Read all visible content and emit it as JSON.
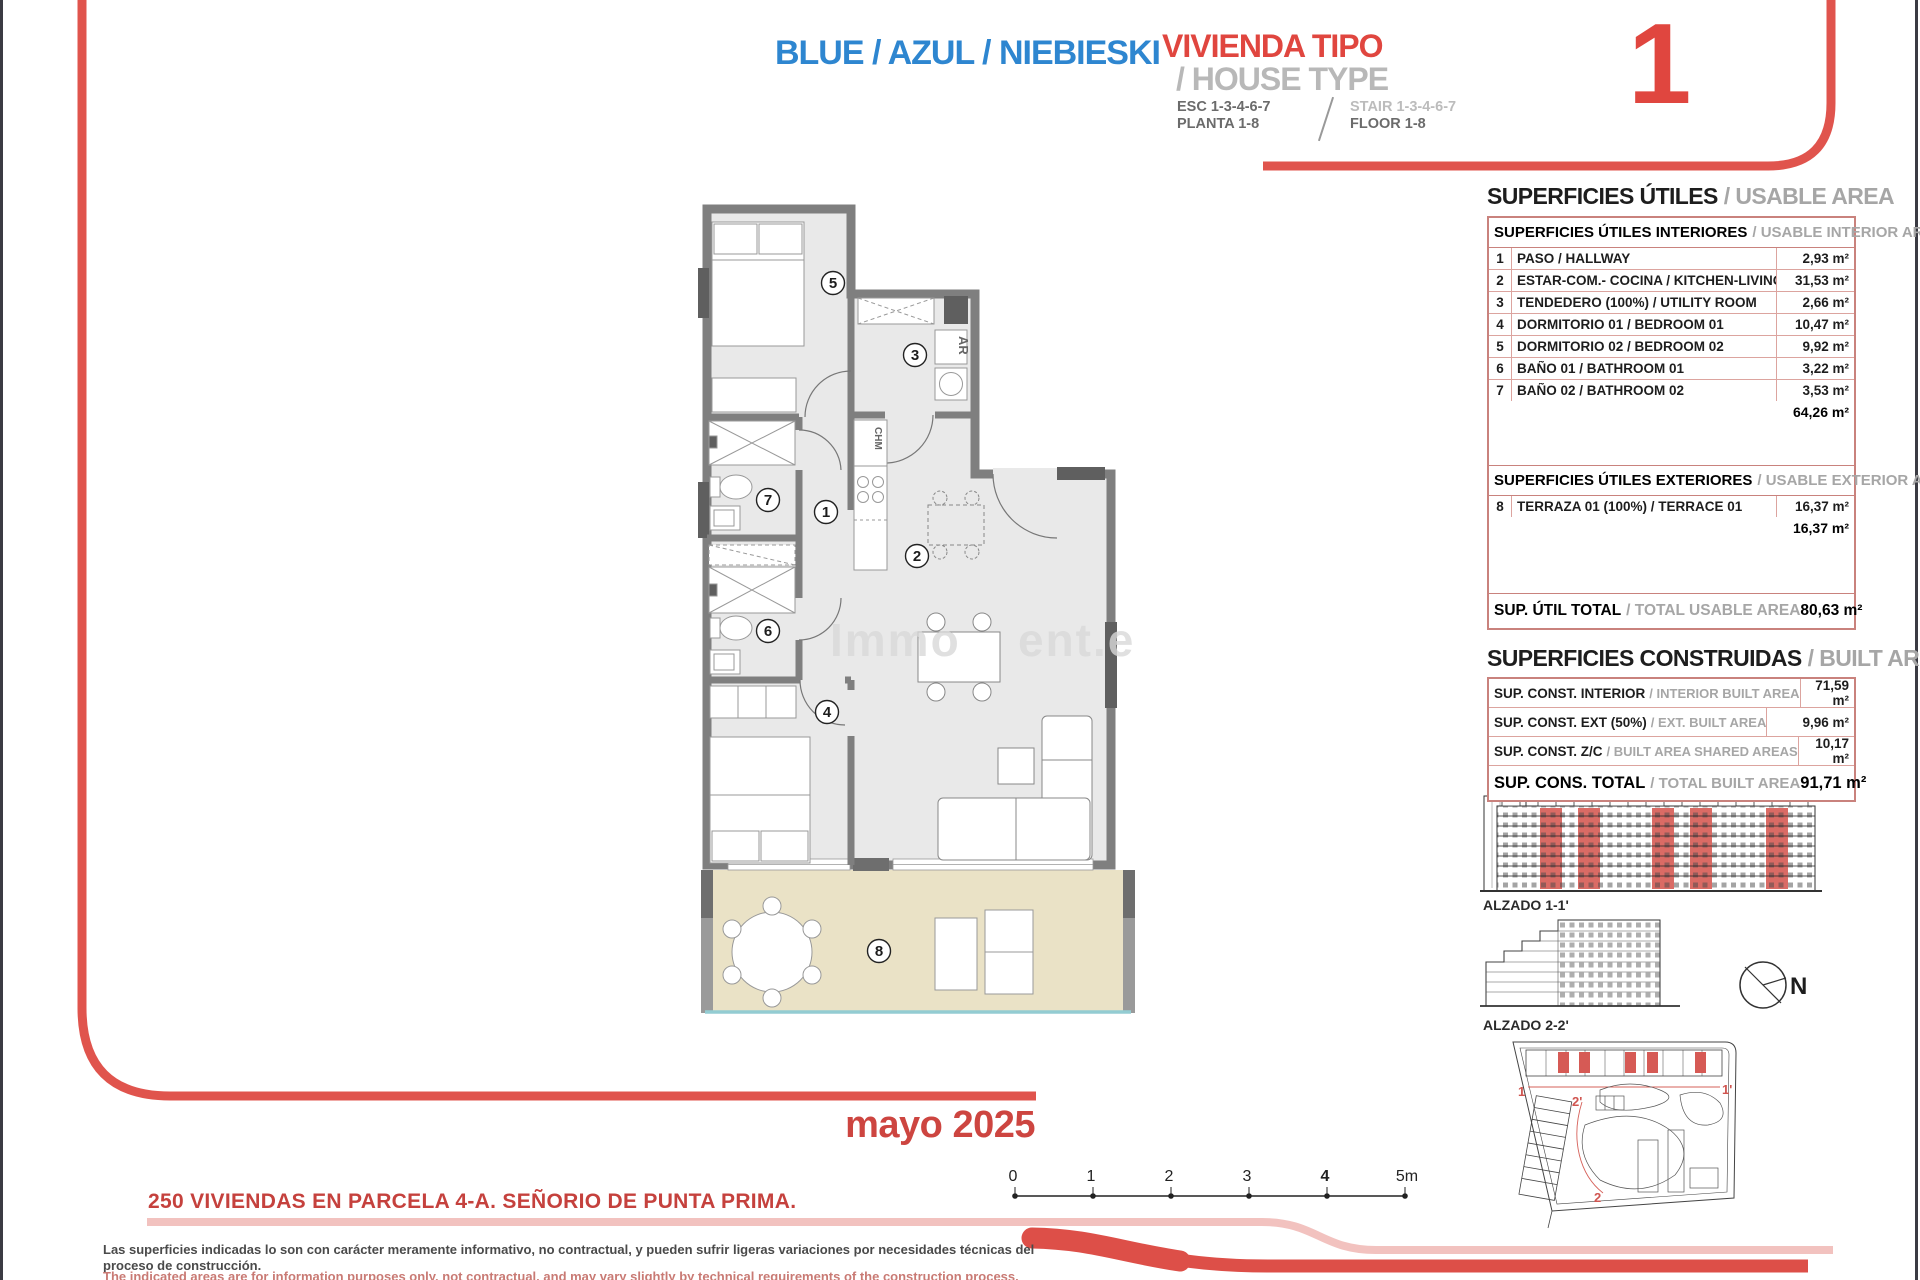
{
  "header": {
    "title_blue": "BLUE / AZUL / NIEBIESKI",
    "house_type_es": "VIVIENDA TIPO",
    "house_type_en": "/ HOUSE TYPE",
    "type_number": "1",
    "esc_es": "ESC 1-3-4-6-7",
    "planta_es": "PLANTA 1-8",
    "stair_en": "STAIR 1-3-4-6-7",
    "floor_en": "FLOOR 1-8"
  },
  "usable_area": {
    "title_es": "SUPERFICIES ÚTILES",
    "title_en": "/ USABLE AREA",
    "interior_header_es": "SUPERFICIES ÚTILES INTERIORES",
    "interior_header_en": "/ USABLE INTERIOR AREA",
    "interior_rows": [
      {
        "num": "1",
        "label": "PASO / HALLWAY",
        "value": "2,93 m²"
      },
      {
        "num": "2",
        "label": "ESTAR-COM.- COCINA / KITCHEN-LIVING",
        "value": "31,53 m²"
      },
      {
        "num": "3",
        "label": "TENDEDERO (100%) / UTILITY ROOM",
        "value": "2,66 m²"
      },
      {
        "num": "4",
        "label": "DORMITORIO 01 / BEDROOM 01",
        "value": "10,47 m²"
      },
      {
        "num": "5",
        "label": "DORMITORIO 02 / BEDROOM 02",
        "value": "9,92 m²"
      },
      {
        "num": "6",
        "label": "BAÑO 01 / BATHROOM 01",
        "value": "3,22 m²"
      },
      {
        "num": "7",
        "label": "BAÑO 02 / BATHROOM 02",
        "value": "3,53 m²"
      }
    ],
    "interior_subtotal": "64,26 m²",
    "exterior_header_es": "SUPERFICIES ÚTILES EXTERIORES",
    "exterior_header_en": "/ USABLE EXTERIOR AREA",
    "exterior_rows": [
      {
        "num": "8",
        "label": "TERRAZA 01 (100%) / TERRACE 01",
        "value": "16,37 m²"
      }
    ],
    "exterior_subtotal": "16,37 m²",
    "total_label_es": "SUP. ÚTIL TOTAL",
    "total_label_en": "/ TOTAL USABLE AREA",
    "total_value": "80,63 m²"
  },
  "built_area": {
    "title_es": "SUPERFICIES CONSTRUIDAS",
    "title_en": "/ BUILT AREA",
    "rows": [
      {
        "label_es": "SUP. CONST. INTERIOR",
        "label_en": "/ INTERIOR BUILT AREA",
        "value": "71,59 m²"
      },
      {
        "label_es": "SUP. CONST. EXT (50%)",
        "label_en": "/ EXT. BUILT AREA",
        "value": "9,96 m²"
      },
      {
        "label_es": "SUP. CONST. Z/C",
        "label_en": "/ BUILT AREA SHARED AREAS",
        "value": "10,17 m²"
      }
    ],
    "total_label_es": "SUP. CONS. TOTAL",
    "total_label_en": "/ TOTAL BUILT AREA",
    "total_value": "91,71 m²"
  },
  "floor_plan": {
    "room_labels": [
      "1",
      "2",
      "3",
      "4",
      "5",
      "6",
      "7",
      "8"
    ],
    "appliance_ar": "AR",
    "appliance_chm": "CHM",
    "watermark_left": "Immo",
    "watermark_right": "ent.e"
  },
  "annexes": {
    "alzado1_label": "ALZADO 1-1'",
    "alzado2_label": "ALZADO 2-2'",
    "compass_label": "N",
    "site_markers": {
      "m1": "1",
      "m1p": "1'",
      "m2p": "2'",
      "m2": "2"
    }
  },
  "footer": {
    "date": "mayo 2025",
    "project": "250 VIVIENDAS EN PARCELA 4-A. SEÑORIO DE PUNTA PRIMA.",
    "scale_ticks": [
      "0",
      "1",
      "2",
      "3",
      "4",
      "5m"
    ],
    "disclaimer_es": "Las superficies indicadas lo son con carácter meramente informativo, no contractual, y pueden sufrir ligeras variaciones por necesidades técnicas del proceso de construcción.",
    "disclaimer_en": "The indicated areas are for information purposes only, not contractual, and may vary slightly by technical requirements of the construction process."
  },
  "colors": {
    "accent_red": "#e0463f",
    "accent_blue": "#2e86d0",
    "frame_red": "#e0544d",
    "pink": "#f2c2bf",
    "table_border": "#c9827d",
    "wall_gray": "#7f7f7f",
    "terrace_beige": "#eae2c6",
    "terrace_rail_blue": "#93ccd2"
  }
}
